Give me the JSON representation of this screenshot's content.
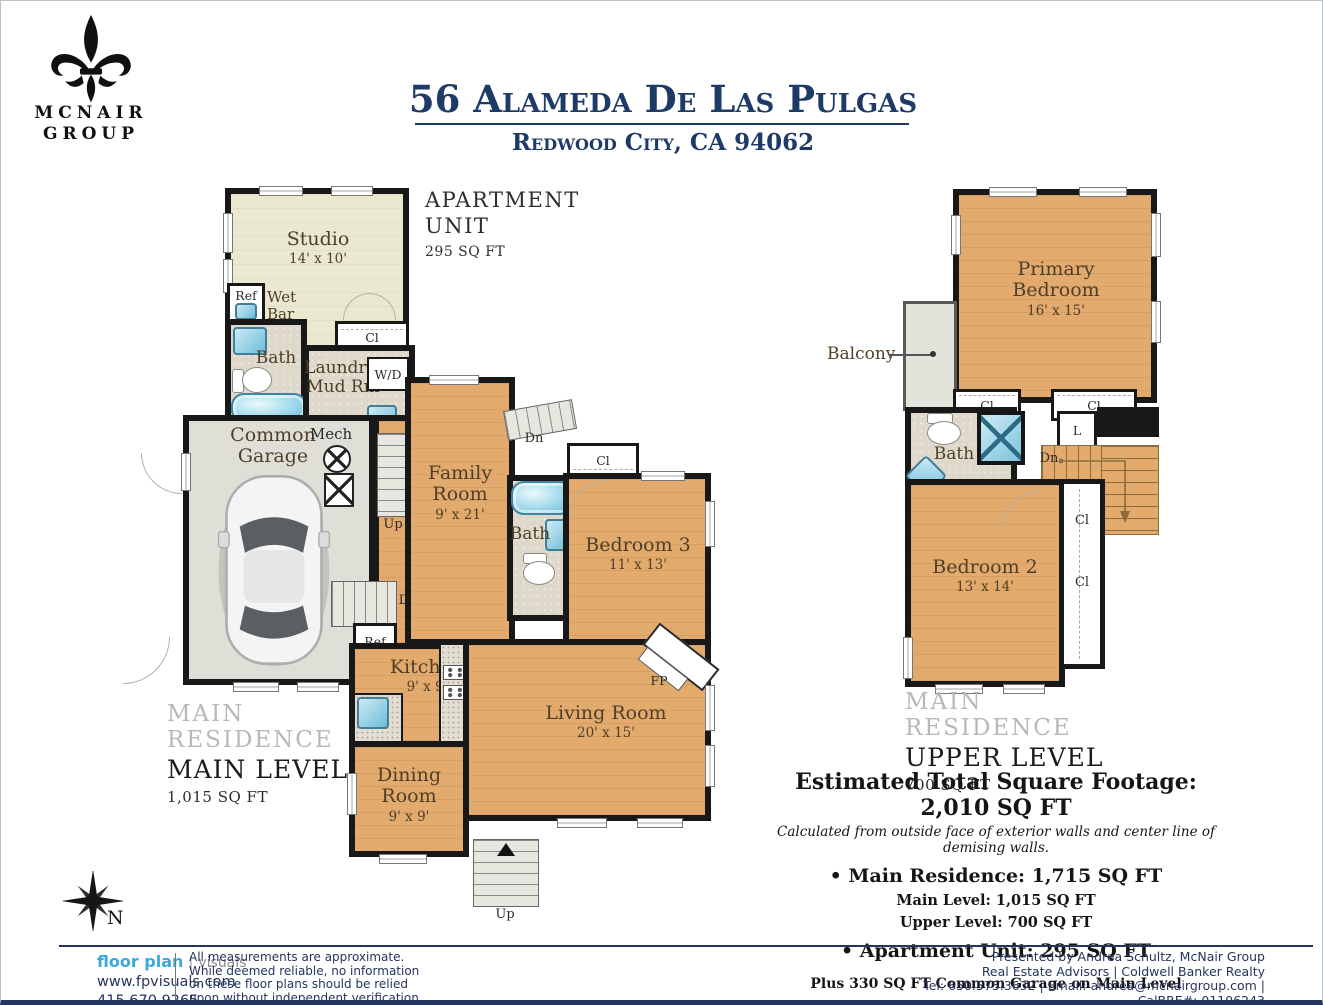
{
  "colors": {
    "navy": "#1e3a66",
    "wood": "#e2ab6d",
    "brand_blue": "#3aa9da"
  },
  "brand": {
    "name_top": "MCNAIR",
    "name_bottom": "GROUP"
  },
  "header": {
    "title": "56 Alameda De Las Pulgas",
    "subtitle": "Redwood City, CA 94062"
  },
  "labels": {
    "cl": "Cl",
    "l": "L",
    "up": "Up",
    "dn": "Dn",
    "ref": "Ref",
    "dw": "DW",
    "wd": "W/D",
    "fp": "FP",
    "mech": "Mech",
    "bath": "Bath",
    "n": "N"
  },
  "apartment": {
    "title1": "APARTMENT",
    "title2": "UNIT",
    "sqft": "295 SQ FT",
    "studio_name": "Studio",
    "studio_dim": "14' x 10'",
    "wet1": "Wet",
    "wet2": "Bar",
    "laundry1": "Laundry/",
    "laundry2": "Mud Rm"
  },
  "main_level": {
    "residence": "MAIN RESIDENCE",
    "level": "MAIN LEVEL",
    "sqft": "1,015 SQ FT",
    "garage1": "Common",
    "garage2": "Garage",
    "family1": "Family",
    "family2": "Room",
    "family_dim": "9' x 21'",
    "bedroom3": "Bedroom 3",
    "bedroom3_dim": "11' x 13'",
    "kitchen": "Kitchen",
    "kitchen_dim": "9' x 9'",
    "living": "Living Room",
    "living_dim": "20' x 15'",
    "dining1": "Dining",
    "dining2": "Room",
    "dining_dim": "9' x 9'"
  },
  "upper_level": {
    "residence": "MAIN RESIDENCE",
    "level": "UPPER LEVEL",
    "sqft": "700 SQ FT",
    "primary": "Primary Bedroom",
    "primary_dim": "16' x 15'",
    "balcony": "Balcony",
    "bedroom2": "Bedroom 2",
    "bedroom2_dim": "13' x 14'"
  },
  "totals": {
    "title": "Estimated Total Square Footage: 2,010 SQ FT",
    "note": "Calculated from outside face of exterior walls and center line of demising walls.",
    "main_residence": "• Main Residence: 1,715 SQ FT",
    "main_level": "Main Level: 1,015 SQ FT",
    "upper_level": "Upper Level: 700 SQ FT",
    "apartment": "• Apartment Unit: 295 SQ FT",
    "garage_note": "Plus 330 SQ FT Common Garage on Main Level"
  },
  "footer": {
    "brand_primary": "floor plan",
    "brand_divider": "|",
    "brand_secondary": "visuals",
    "website": "www.fpvisuals.com",
    "phone": "415.670.9265",
    "disclaimer": [
      "All measurements are approximate.",
      "While deemed reliable, no information",
      "on these floor plans should be relied",
      "upon without independent verification."
    ],
    "presented": [
      "Presented by Andrea Schultz, McNair Group",
      "Real Estate Advisors | Coldwell Banker Realty",
      "Tel: 650.575.3632 | Email: andrea@mcnairgroup.com | CalBRE#: 01196243"
    ]
  }
}
